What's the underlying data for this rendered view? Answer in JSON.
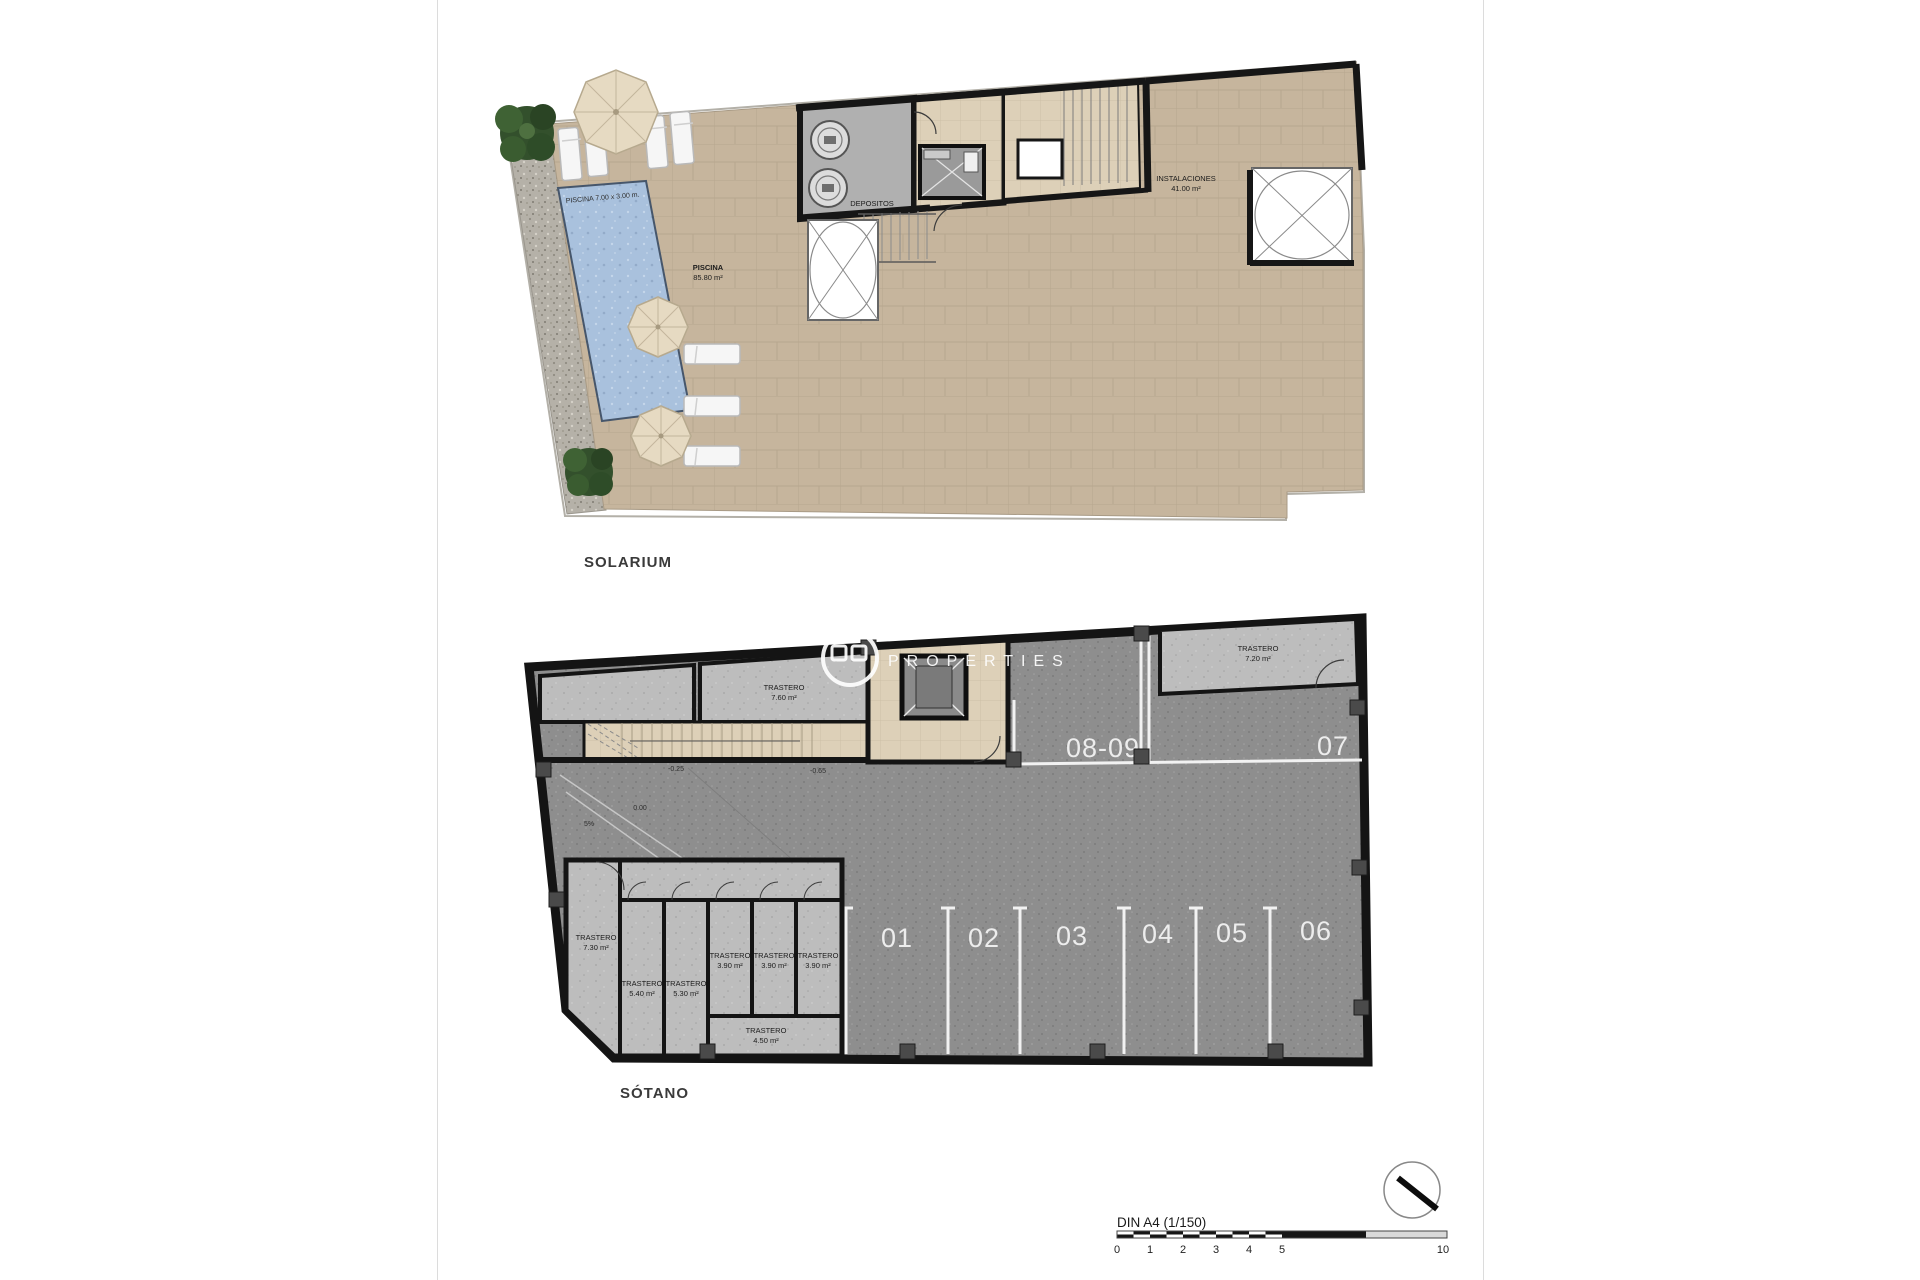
{
  "solarium": {
    "title": "SOLARIUM",
    "pool_dim": "PISCINA 7.00 x 3.00 m.",
    "pool_name": "PISCINA",
    "pool_area": "85.80 m²",
    "depositos": "DEPOSITOS",
    "instal_name": "INSTALACIONES",
    "instal_area": "41.00 m²"
  },
  "basement": {
    "title": "SÓTANO",
    "tr_top": {
      "name": "TRASTERO",
      "area": "7.60 m²"
    },
    "tr_topright": {
      "name": "TRASTERO",
      "area": "7.20 m²"
    },
    "bay_0809": "08-09",
    "bay_07": "07",
    "bays": [
      "01",
      "02",
      "03",
      "04",
      "05",
      "06"
    ],
    "tr_left": {
      "name": "TRASTERO",
      "area": "7.30 m²"
    },
    "cells": [
      {
        "name": "TRASTERO",
        "area": "5.40 m²"
      },
      {
        "name": "TRASTERO",
        "area": "5.30 m²"
      },
      {
        "name": "TRASTERO",
        "area": "3.90 m²"
      },
      {
        "name": "TRASTERO",
        "area": "3.90 m²"
      },
      {
        "name": "TRASTERO",
        "area": "3.90 m²"
      }
    ],
    "tr_bottom": {
      "name": "TRASTERO",
      "area": "4.50 m²"
    },
    "lv_000": "0.00",
    "lv_5pct": "5%",
    "lv_m025": "-0.25",
    "lv_m065": "-0.65"
  },
  "watermark": {
    "line2": "PROPERTIES"
  },
  "scalebar": {
    "label": "DIN A4 (1/150)",
    "ticks": [
      "0",
      "1",
      "2",
      "3",
      "4",
      "5",
      "10"
    ]
  },
  "colors": {
    "terrace": "#c6b59d",
    "pool": "#a9c1dd",
    "floor_dark": "#8e8e8e",
    "room_gray": "#bdbdbd",
    "beige": "#ddd0b8",
    "wall": "#161616",
    "white_line": "#f2f2f2"
  }
}
